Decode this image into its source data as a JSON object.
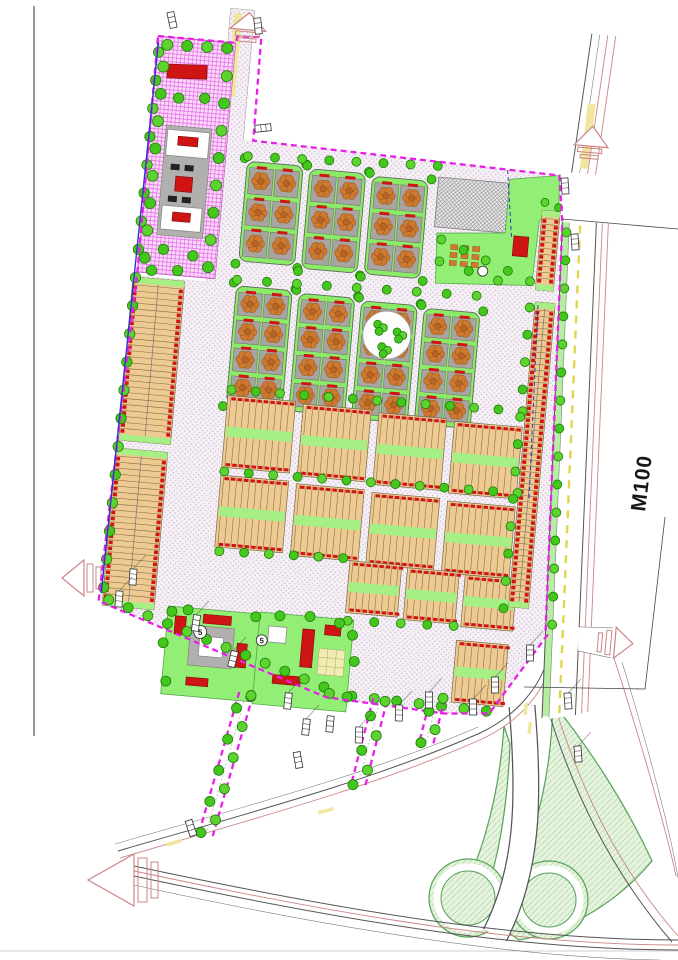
{
  "document": {
    "type_label": "residential master plan drawing",
    "annotations": {
      "corridor_width_label": "M100",
      "school1_number": "5",
      "school2_number": "5"
    },
    "icons": {
      "tree": "circle-glyph",
      "car_marker": "hatched-rectangle",
      "road_continuation_arrow": "triangle-with-bars"
    },
    "palette": {
      "boundary": "#e91fe9",
      "boundary_blue": "#3333cc",
      "road_fill": "#f5f0f5",
      "road_dot": "#c9aec9",
      "block_green": "#8bea68",
      "median_green": "#a6ef85",
      "rowhouse_tan": "#ecca92",
      "rowhouse_line": "#8a6a40",
      "unit_red": "#d01414",
      "villa_lot_gray": "#a7a4a1",
      "villa_orange": "#cd7a30",
      "tree_green": "#44c71c",
      "tree_dark": "#1d7d07",
      "purple_zone": "#fbdcfb",
      "purple_grid": "#e366e3",
      "park_green": "#93ee75",
      "school_red": "#cf1414",
      "hatch_gray": "#8e8e8e",
      "interchange_green": "#e5f3df",
      "interchange_edge": "#57a257",
      "road_line": "#555555",
      "pink_line": "#cc8585",
      "yellow": "#e3d44e"
    }
  }
}
